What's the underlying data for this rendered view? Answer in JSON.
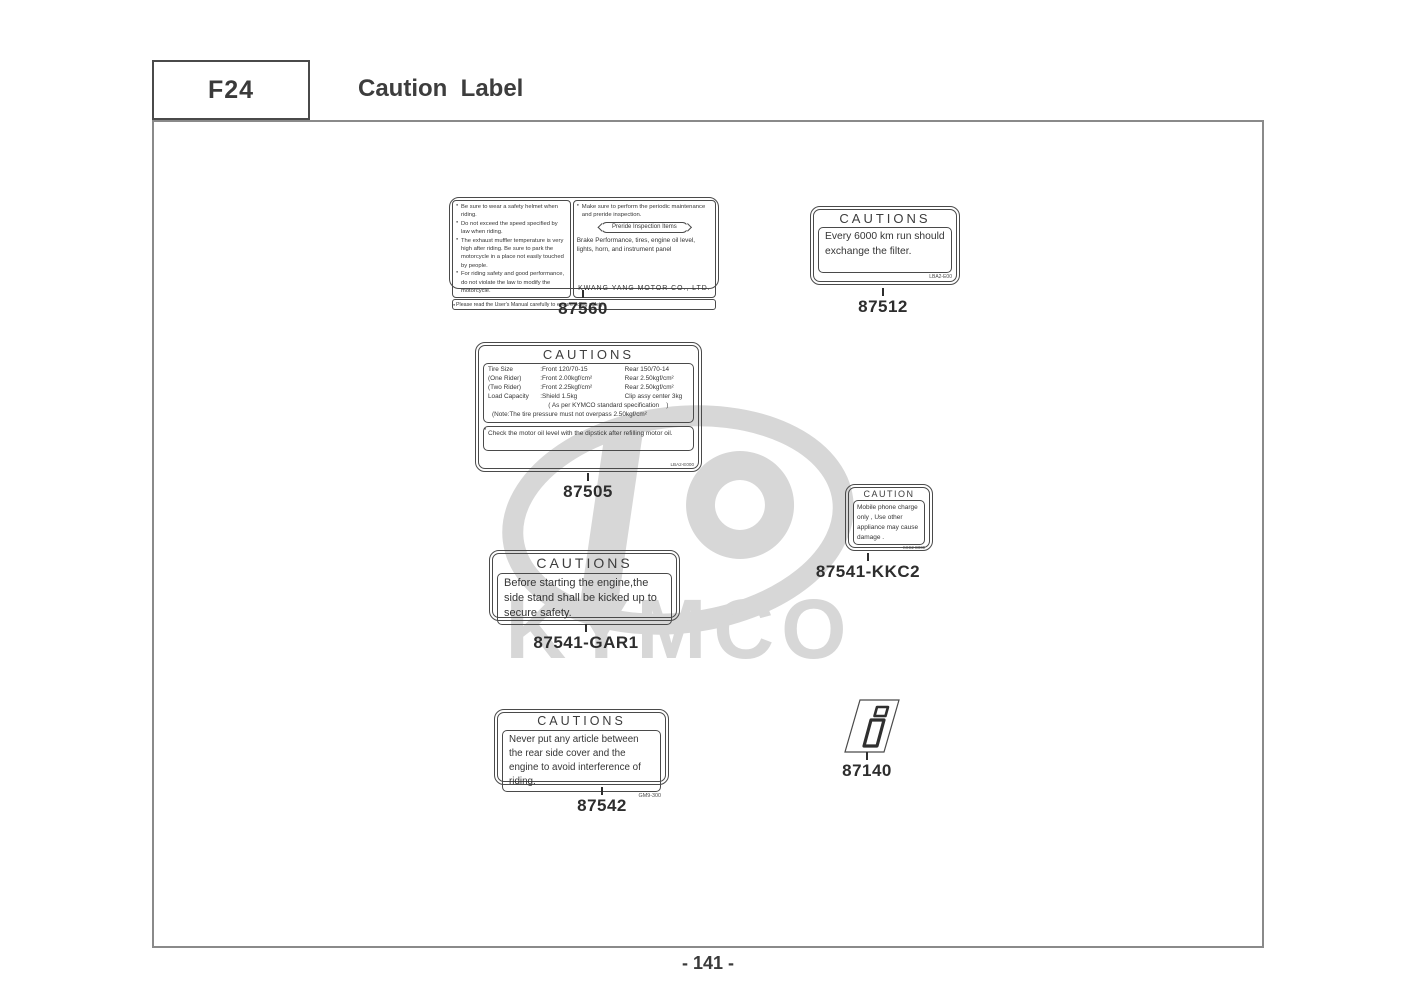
{
  "header": {
    "code": "F24",
    "title": "Caution  Label"
  },
  "footer": {
    "page_number": "- 141 -"
  },
  "watermark": {
    "brand": "KYMCO",
    "color": "#d7d7d7"
  },
  "labels": {
    "l87560": {
      "part_number": "87560",
      "left_items": [
        "Be sure to wear a safety helmet when riding.",
        "Do not exceed  the speed specified by law when riding.",
        "The exhaust muffler temperature is very high after riding. Be sure to park the motorcycle in a place not easily touched by people.",
        "For riding safety and good performance, do not violate the law to modify the motorcycle."
      ],
      "right_note": "Make sure to perform the periodic maintenance and preride inspection.",
      "preride_title": "Preride Inspection Items",
      "right_body": "Brake Performance, tires, engine oil level, lights, horn, and instrument panel",
      "company": "KWANG YANG MOTOR CO., LTD.",
      "footer_note": "Please read the User's Manual carefully to ensure riding safety."
    },
    "l87512": {
      "part_number": "87512",
      "title": "CAUTIONS",
      "body": "Every 6000 km run should exchange the filter.",
      "code": "LBA2-E00"
    },
    "l87505": {
      "part_number": "87505",
      "title": "CAUTIONS",
      "rows": [
        [
          "Tire Size",
          ":Front 120/70-15",
          "Rear 150/70-14"
        ],
        [
          "(One Rider)",
          ":Front 2.00kgf/cm²",
          "Rear 2.50kgf/cm²"
        ],
        [
          "(Two Rider)",
          ":Front 2.25kgf/cm²",
          "Rear 2.50kgf/cm²"
        ],
        [
          "Load Capacity",
          ":Shield 1.5kg",
          "Clip assy center 3kg"
        ]
      ],
      "spec_note": "( As per KYMCO standard specification    )",
      "pressure_note": "(Note:The tire pressure must not overpass 2.50kgf/cm²",
      "oil_note": "Check the motor oil level with the dipstick after refilling motor oil.",
      "code": "LBA2-E000"
    },
    "l87541_kkc2": {
      "part_number": "87541-KKC2",
      "title": "CAUTION",
      "body": "Mobile phone charge only , Use other appliance may cause damage .",
      "code": "KKC2-E000"
    },
    "l87541_gar1": {
      "part_number": "87541-GAR1",
      "title": "CAUTIONS",
      "body": "Before starting the engine,the side stand shall be kicked up to secure safety."
    },
    "l87542": {
      "part_number": "87542",
      "title": "CAUTIONS",
      "body": "Never put any article between the rear side cover and the engine to avoid interference of riding.",
      "code": "GM9-300"
    },
    "l87140": {
      "part_number": "87140"
    }
  }
}
